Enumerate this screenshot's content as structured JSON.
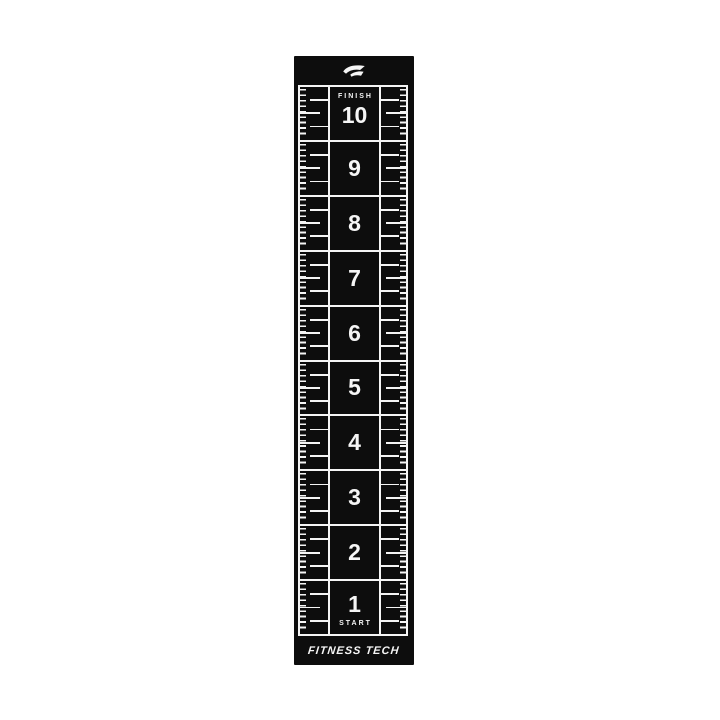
{
  "image": {
    "type": "product-photo",
    "background_color": "#ffffff"
  },
  "mat": {
    "brand": "FITNESS TECH",
    "logo_icon": "panther-logo-icon",
    "finish_label": "FINISH",
    "start_label": "START",
    "colors": {
      "mat_black": "#0d0d0d",
      "markings_white": "#f5f5f5"
    },
    "cells": [
      {
        "label": "10"
      },
      {
        "label": "9"
      },
      {
        "label": "8"
      },
      {
        "label": "7"
      },
      {
        "label": "6"
      },
      {
        "label": "5"
      },
      {
        "label": "4"
      },
      {
        "label": "3"
      },
      {
        "label": "2"
      },
      {
        "label": "1"
      }
    ]
  }
}
